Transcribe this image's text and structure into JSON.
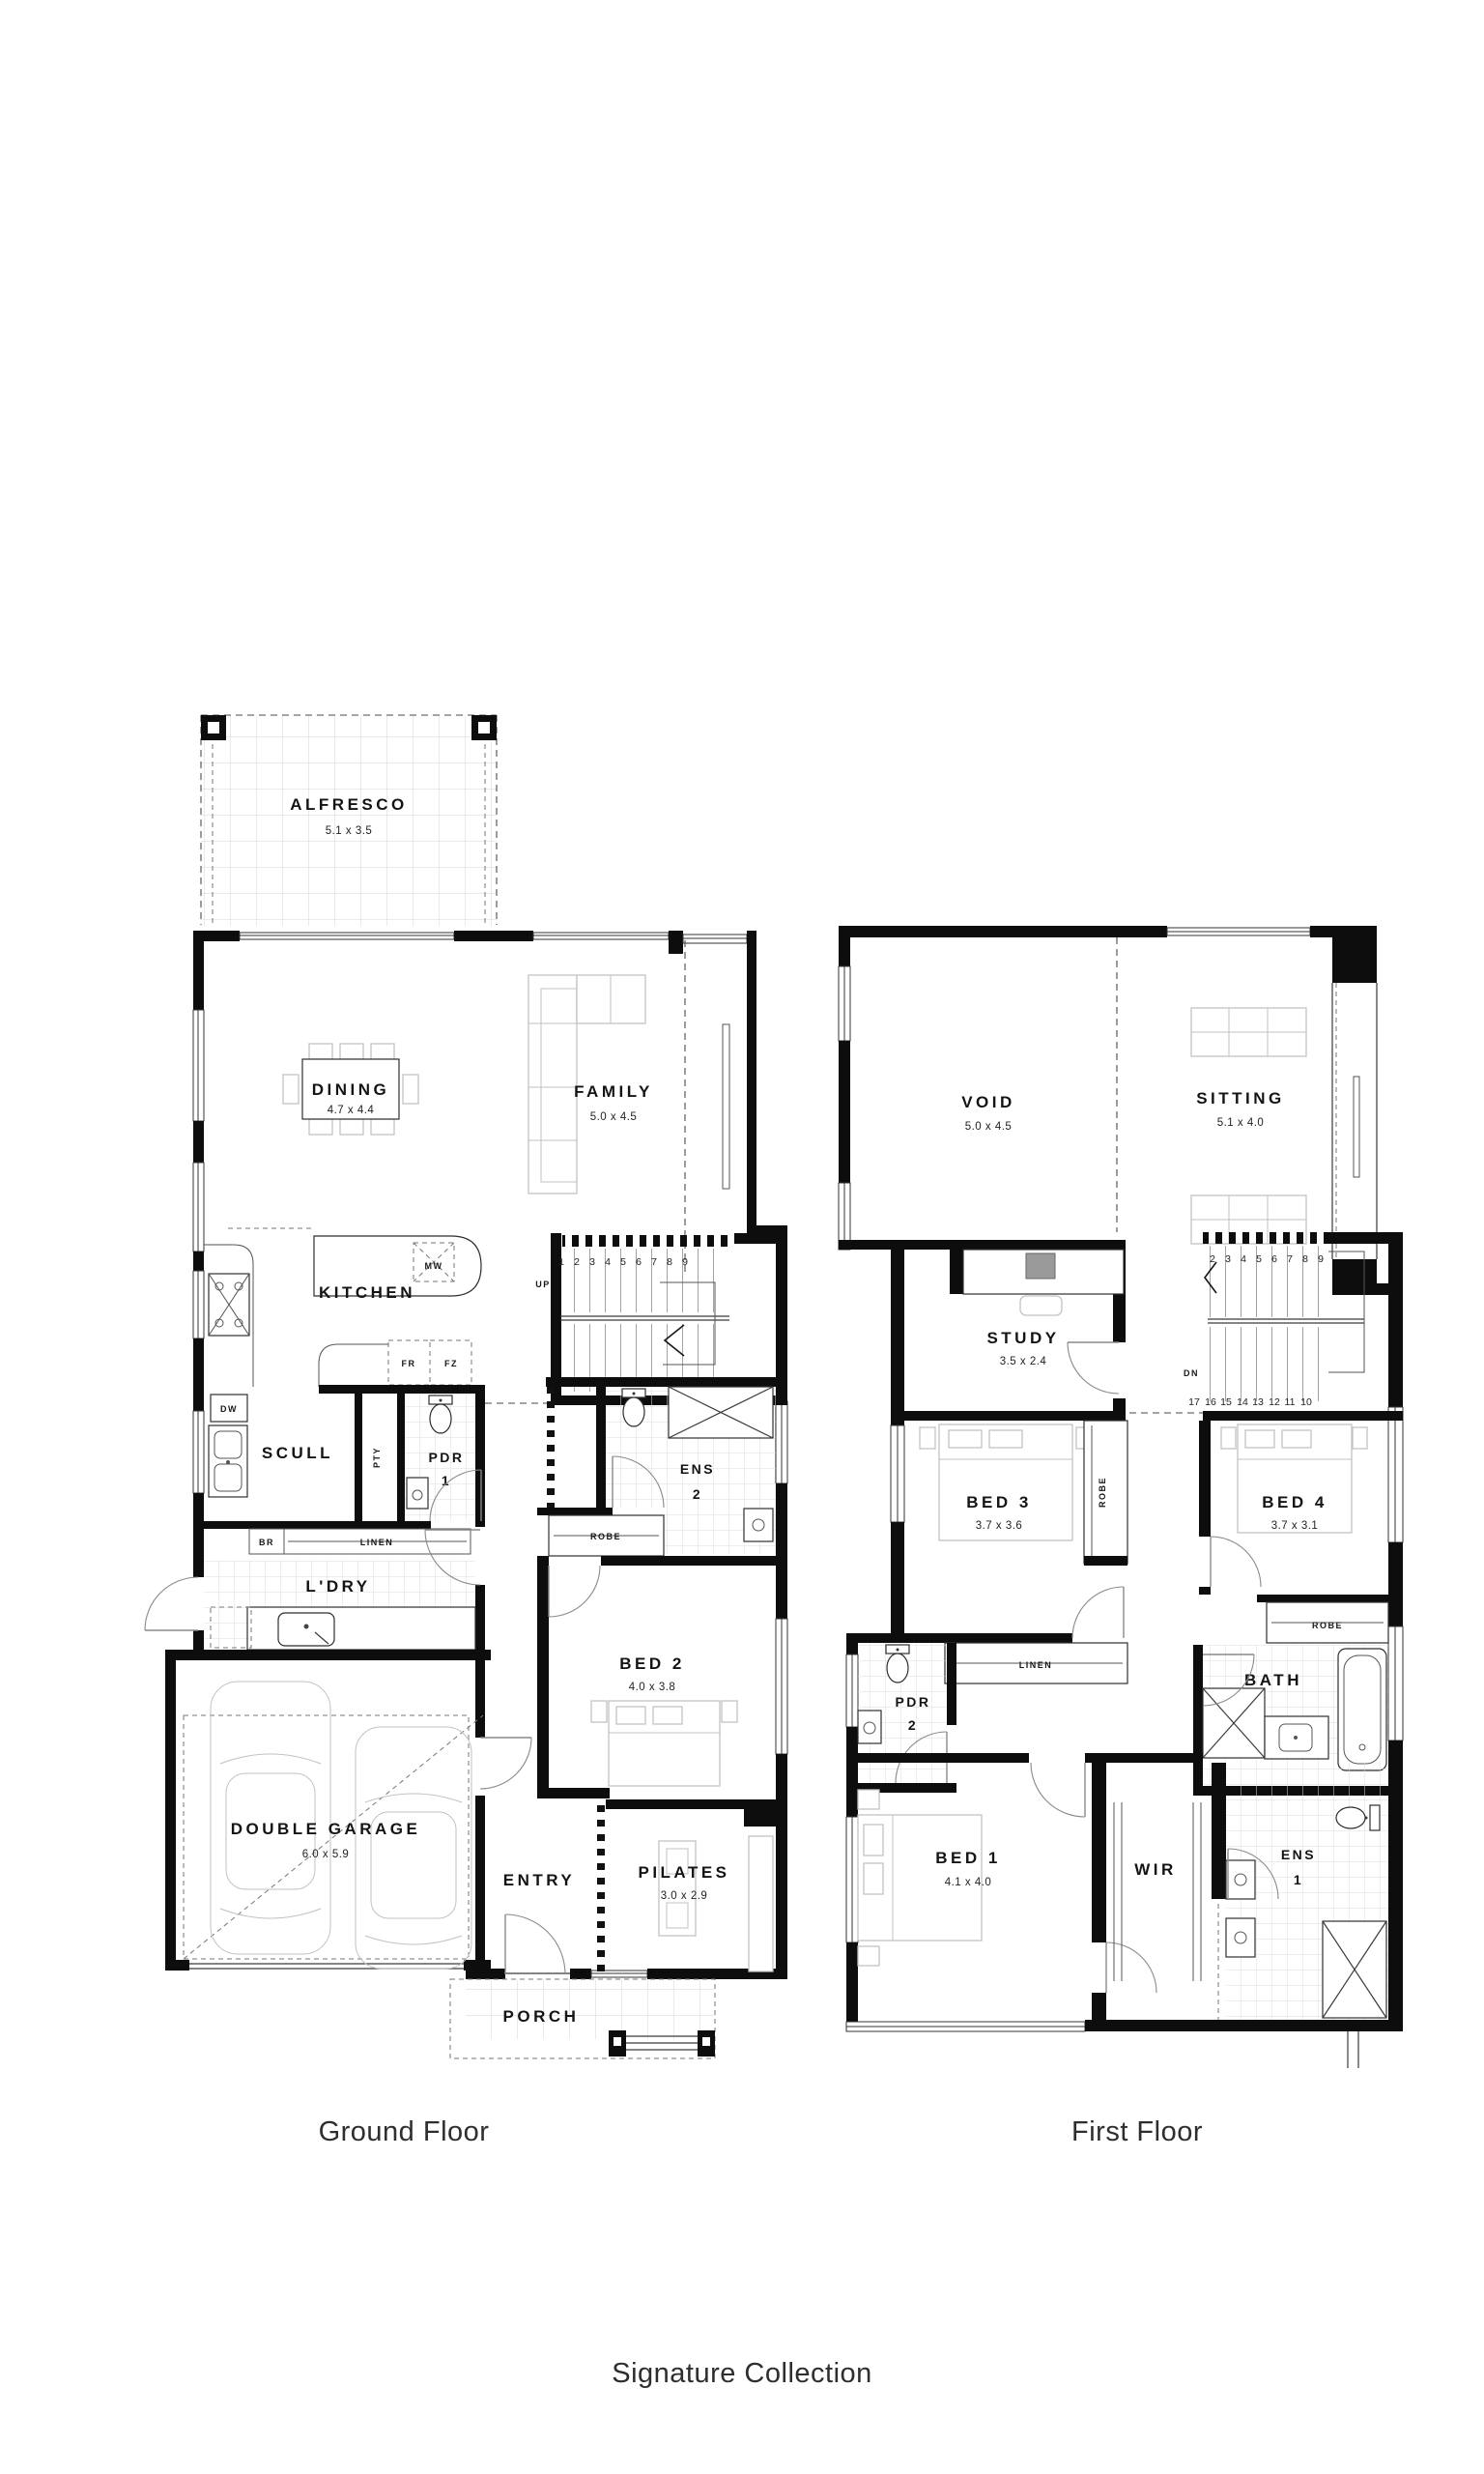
{
  "captions": {
    "ground": "Ground Floor",
    "first": "First Floor",
    "collection": "Signature Collection"
  },
  "ground_floor": {
    "alfresco_name": "ALFRESCO",
    "alfresco_dim": "5.1 x 3.5",
    "dining_name": "DINING",
    "dining_dim": "4.7 x 4.4",
    "family_name": "FAMILY",
    "family_dim": "5.0 x 4.5",
    "kitchen_name": "KITCHEN",
    "scull_name": "SCULL",
    "pdr1_name": "PDR",
    "pdr1_num": "1",
    "ens2_name": "ENS",
    "ens2_num": "2",
    "ldry_name": "L'DRY",
    "bed2_name": "BED 2",
    "bed2_dim": "4.0 x 3.8",
    "garage_name": "DOUBLE GARAGE",
    "garage_dim": "6.0 x 5.9",
    "entry_name": "ENTRY",
    "pilates_name": "PILATES",
    "pilates_dim": "3.0 x 2.9",
    "porch_name": "PORCH",
    "labels": {
      "mw": "MW",
      "fr": "FR",
      "fz": "FZ",
      "dw": "DW",
      "pty": "PTY",
      "br": "BR",
      "linen": "LINEN",
      "robe": "ROBE",
      "up": "UP"
    },
    "stair_numbers": [
      "1",
      "2",
      "3",
      "4",
      "5",
      "6",
      "7",
      "8",
      "9"
    ]
  },
  "first_floor": {
    "void_name": "VOID",
    "void_dim": "5.0 x 4.5",
    "sitting_name": "SITTING",
    "sitting_dim": "5.1 x 4.0",
    "study_name": "STUDY",
    "study_dim": "3.5 x 2.4",
    "bed3_name": "BED 3",
    "bed3_dim": "3.7 x 3.6",
    "bed4_name": "BED 4",
    "bed4_dim": "3.7 x 3.1",
    "pdr2_name": "PDR",
    "pdr2_num": "2",
    "bath_name": "BATH",
    "bed1_name": "BED 1",
    "bed1_dim": "4.1 x 4.0",
    "wir_name": "WIR",
    "ens1_name": "ENS",
    "ens1_num": "1",
    "labels": {
      "linen": "LINEN",
      "robe_bed3": "ROBE",
      "robe_bed4": "ROBE",
      "dn": "DN"
    },
    "stair_numbers_top": [
      "2",
      "3",
      "4",
      "5",
      "6",
      "7",
      "8",
      "9"
    ],
    "stair_numbers_bottom": [
      "17",
      "16",
      "15",
      "14",
      "13",
      "12",
      "11",
      "10"
    ]
  }
}
